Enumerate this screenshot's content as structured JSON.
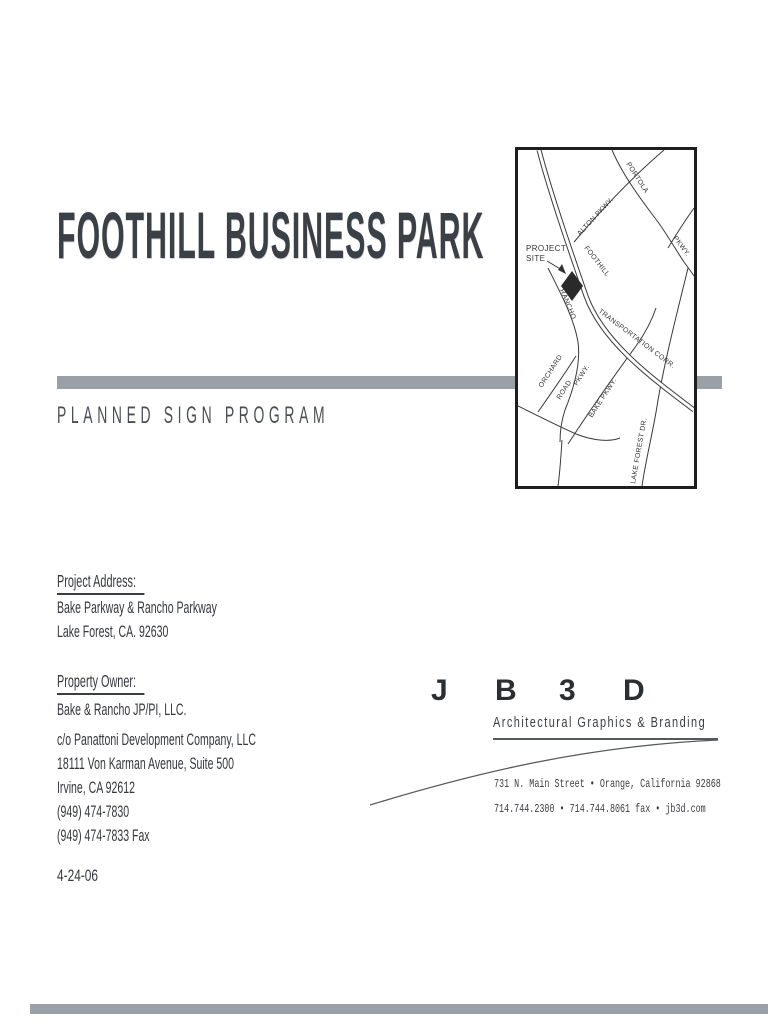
{
  "page": {
    "title": "FOOTHILL BUSINESS PARK",
    "subtitle": "PLANNED SIGN PROGRAM",
    "date": "4-24-06"
  },
  "project_address": {
    "heading": "Project Address:",
    "lines": [
      "Bake Parkway & Rancho Parkway",
      "Lake Forest, CA. 92630"
    ]
  },
  "property_owner": {
    "heading": "Property Owner:",
    "owner": "Bake & Rancho JP/PI, LLC.",
    "lines": [
      "c/o Panattoni Development Company, LLC",
      "18111 Von Karman Avenue, Suite 500",
      "Irvine, CA 92612",
      "(949) 474-7830",
      "(949) 474-7833 Fax"
    ]
  },
  "logo": {
    "letters": [
      "J",
      "B",
      "3",
      "D"
    ],
    "tagline": "Architectural Graphics & Branding",
    "address_line1": "731 N. Main Street • Orange, California 92868",
    "address_line2": "714.744.2300 • 714.744.8061 fax • jb3d.com"
  },
  "map": {
    "project_site": {
      "line1": "PROJECT",
      "line2": "SITE"
    },
    "roads": {
      "foothill": "FOOTHILL",
      "transportation": "TRANSPORTATION CORR.",
      "alton": "ALTON PKWY.",
      "portola": "PORTOLA",
      "portola_pkwy": "PKWY.",
      "rancho": "RANCHO",
      "rancho_pkwy": "PKWY.",
      "orchard": "ORCHARD",
      "orchard_road": "ROAD",
      "bake": "BAKE PKWY.",
      "lake_forest": "LAKE FOREST DR."
    }
  },
  "colors": {
    "bar_gray": "#9aa0a7",
    "text": "#34373c",
    "map_line": "#3a3a3a"
  }
}
